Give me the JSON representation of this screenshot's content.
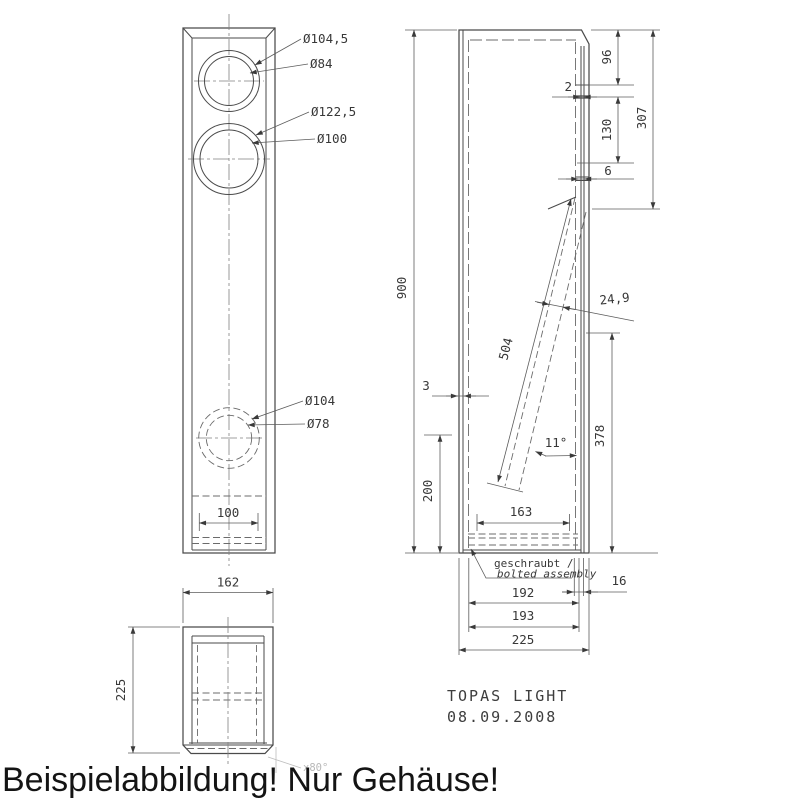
{
  "drawing": {
    "title": "TOPAS LIGHT",
    "date": "08.09.2008",
    "overlay_text": "Beispielabbildung! Nur Gehäuse!",
    "note_line1": "geschraubt /",
    "note_line2": "bolted assembly",
    "colors": {
      "object_line": "#4a4a4a",
      "dimension_line": "#5c5c5c",
      "text": "#383838",
      "overlay_text": "#141414",
      "faint_annotation": "#b8b8b8",
      "background": "#ffffff"
    },
    "front_view": {
      "labels": {
        "tweeter_outer": "Ø104,5",
        "tweeter_inner": "Ø84",
        "woofer_outer": "Ø122,5",
        "woofer_inner": "Ø100",
        "port_outer": "Ø104",
        "port_inner": "Ø78"
      },
      "dims": {
        "port_spacing": "100"
      }
    },
    "side_view": {
      "dims": {
        "height": "900",
        "top_96": "96",
        "recess_2": "2",
        "mid_130": "130",
        "top_307": "307",
        "recess_6": "6",
        "brace_length": "504",
        "brace_width": "24,9",
        "wall_3": "3",
        "angle": "11°",
        "bottom_200": "200",
        "inner_163": "163",
        "right_378": "378",
        "wall_16": "16",
        "inner_192": "192",
        "inner_193": "193",
        "depth_225": "225"
      }
    },
    "top_view": {
      "dims": {
        "width_162": "162",
        "depth_225": "225",
        "chamfer": "x80°"
      }
    }
  }
}
